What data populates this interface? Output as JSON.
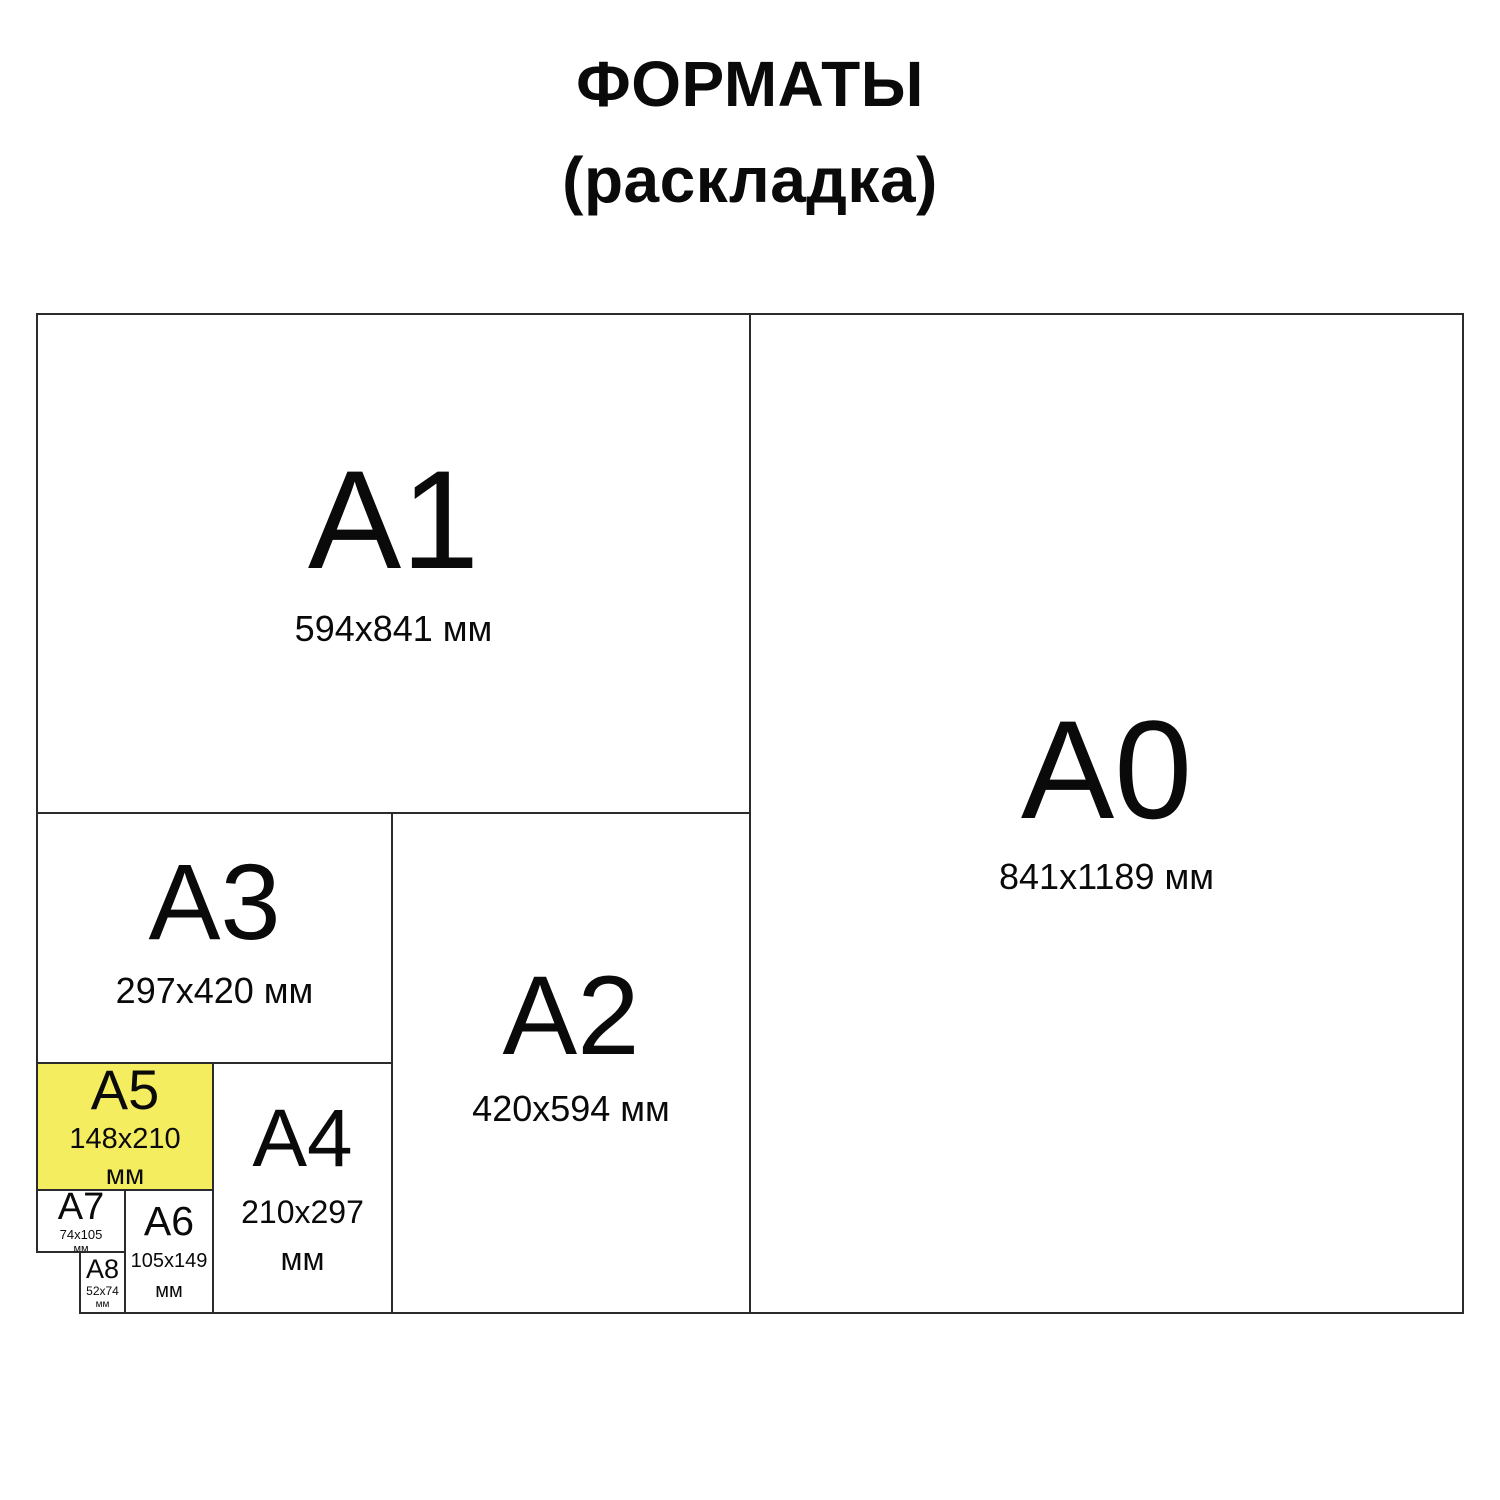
{
  "title": {
    "line1": "ФОРМАТЫ",
    "line2": "(раскладка)"
  },
  "colors": {
    "highlight": "#F4ED5F",
    "line": "#2b2b2b",
    "text": "#0a0a0a",
    "background": "#ffffff"
  },
  "formats": {
    "a0": {
      "label": "A0",
      "size": "841x1189 мм"
    },
    "a1": {
      "label": "A1",
      "size": "594x841 мм"
    },
    "a2": {
      "label": "A2",
      "size": "420x594 мм"
    },
    "a3": {
      "label": "A3",
      "size": "297x420 мм"
    },
    "a4": {
      "label": "A4",
      "size_value": "210x297",
      "size_unit": "мм"
    },
    "a5": {
      "label": "A5",
      "size_value": "148x210",
      "size_unit": "мм",
      "highlighted": true
    },
    "a6": {
      "label": "A6",
      "size_value": "105x149",
      "size_unit": "мм"
    },
    "a7": {
      "label": "A7",
      "size_value": "74x105",
      "size_unit": "мм"
    },
    "a8": {
      "label": "A8",
      "size_value": "52x74",
      "size_unit": "мм"
    }
  }
}
